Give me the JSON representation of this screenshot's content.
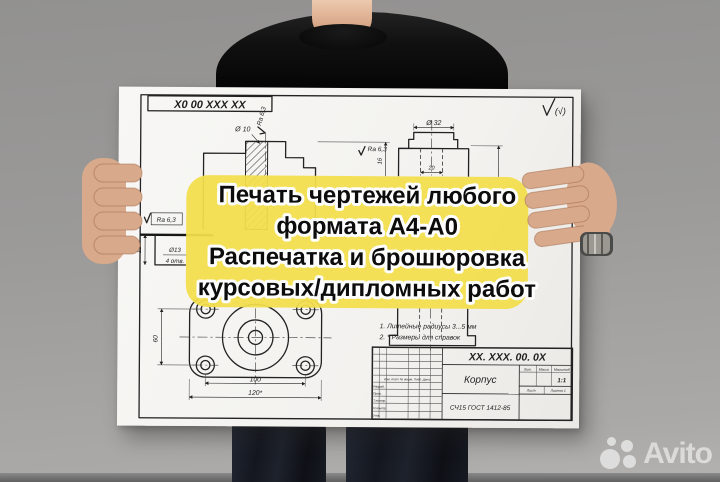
{
  "overlay": {
    "bg_color": "#F2DE4C",
    "lines": {
      "l1": "Печать чертежей любого",
      "l2": "формата А4-А0",
      "l3": "Распечатка и брошюровка",
      "l4": "курсовых/дипломных работ"
    }
  },
  "drawing": {
    "stamp_code": "Х0 00 ХХХ ХХ",
    "general_roughness": "(√)",
    "dims": {
      "d10": "Ø 10",
      "ra63_top": "Ra 6,3",
      "ra63_mid": "Ra 6,3",
      "ra63_left": "Ra 6,3",
      "h16": "16",
      "d32": "Ø 32",
      "w20": "20",
      "h12": "12",
      "d13": "Ø13",
      "d13_holes": "4 отв.",
      "v60": "60",
      "w100": "100",
      "w120": "120*"
    },
    "notes": {
      "n1": "1. Литейные радиусы 3...5 мм",
      "n2": "2. * Размеры для справок"
    },
    "title_block": {
      "designation": "ХХ. ХХХ. 00. 0Х",
      "part_name": "Корпус",
      "material": "СЧ15 ГОСТ 1412-85",
      "lit_label": "Лит.",
      "mass_label": "Масса",
      "scale_label": "Масштаб",
      "scale_value": "1:1",
      "sheet_label": "Лист",
      "sheets_label": "Листов 1",
      "header_row": "Изм. Лист  № докум.  Подп.  Дата",
      "row1": "Разраб.",
      "row2": "Пров.",
      "row3": "Т.контр.",
      "row4": "Н.контр.",
      "row5": "Утв."
    }
  },
  "watermark": {
    "brand": "Avito"
  }
}
